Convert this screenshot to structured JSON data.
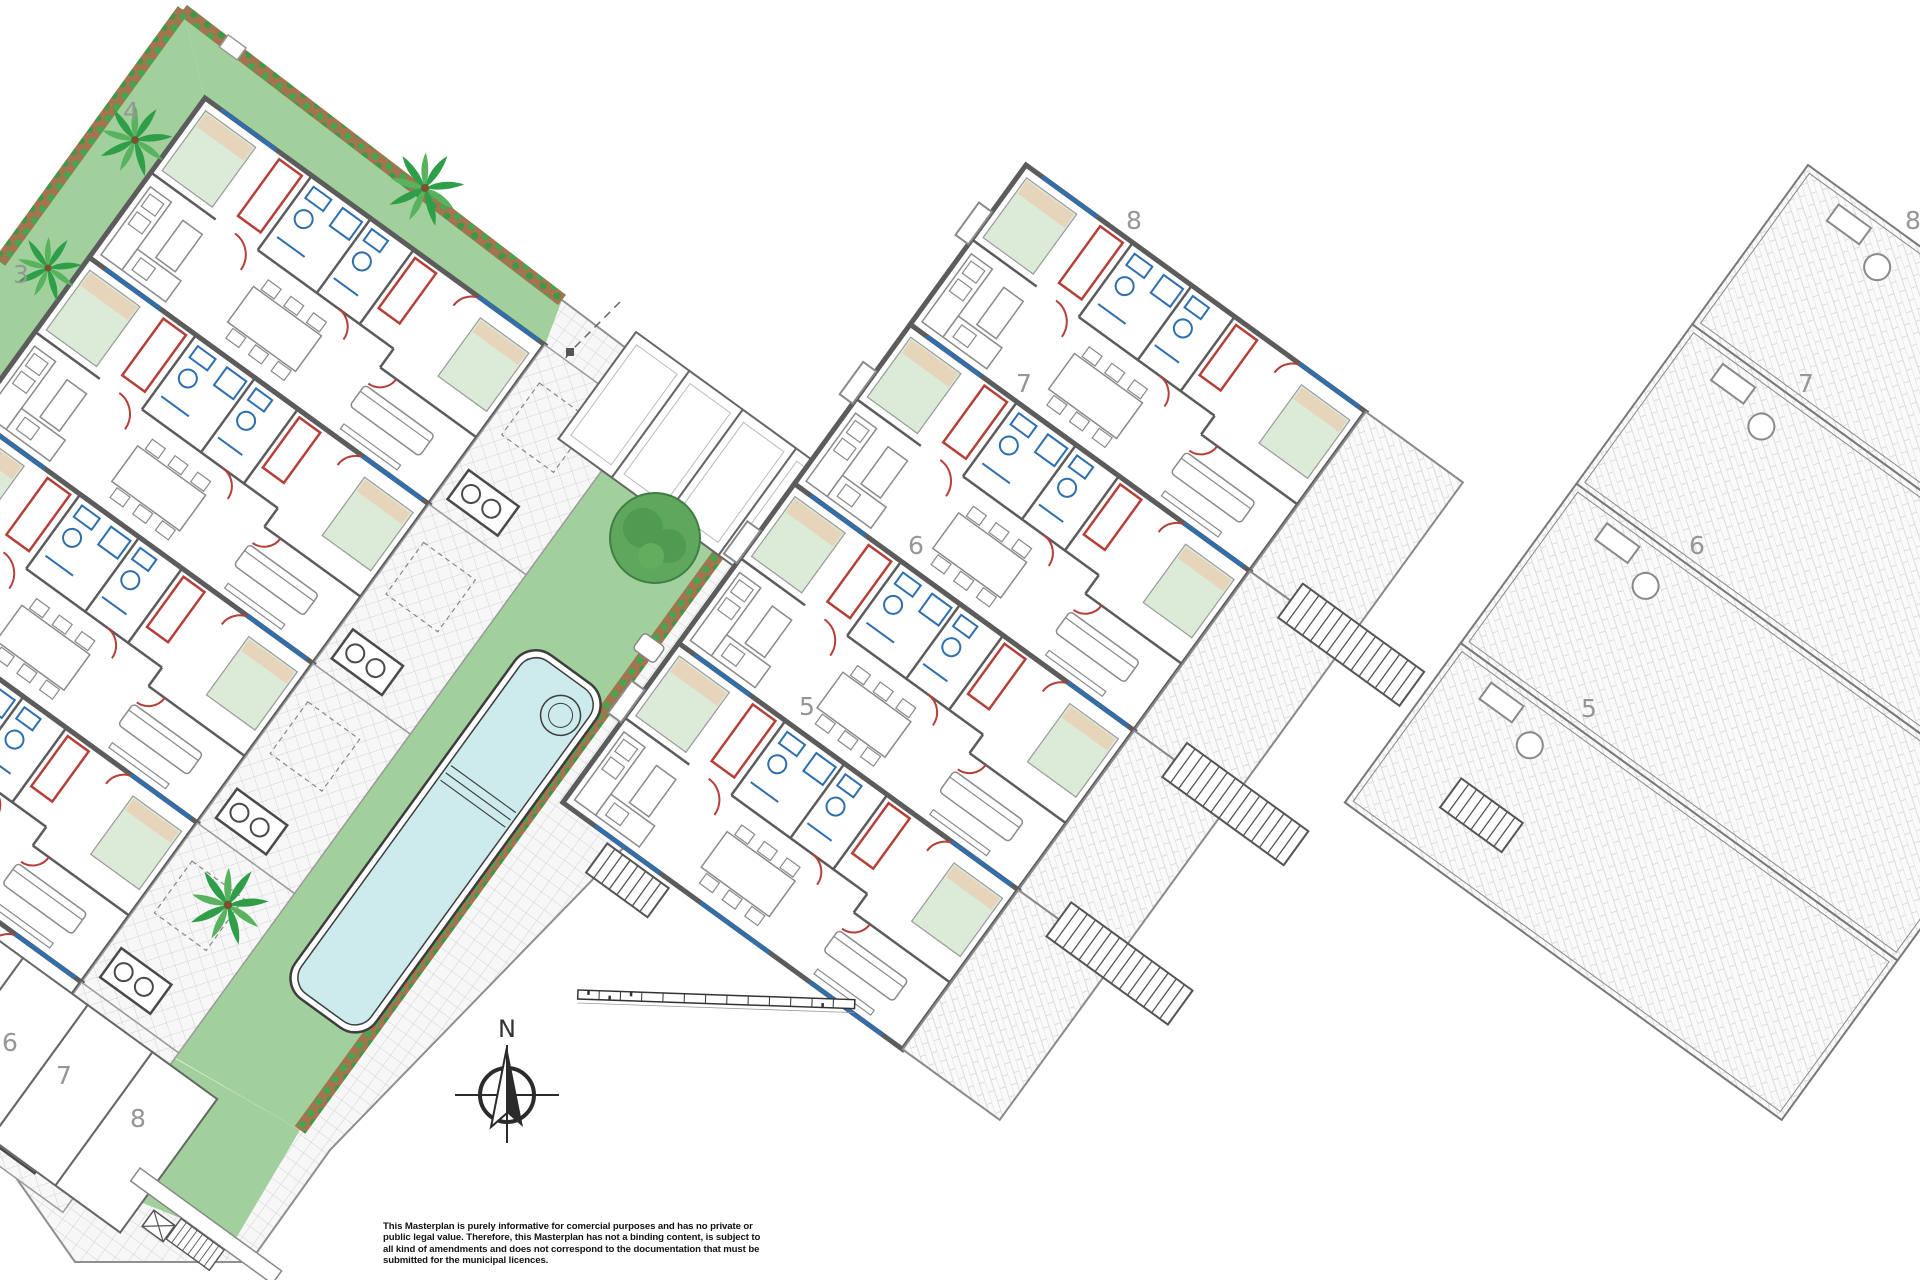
{
  "title": "Residential development masterplan",
  "colors": {
    "background": "#ffffff",
    "garden": "#a2d09c",
    "garden_island": "#a9d4a2",
    "pool_water": "#cdeaed",
    "wall": "#5c5c5c",
    "accent_red": "#b5403a",
    "accent_blue": "#2f6fae",
    "hedge_brown": "#a3744e",
    "hedge_leaf": "#44a64f",
    "bed": "#dcead8",
    "pillow": "#e6d5ba",
    "number_gray": "#969696",
    "paving_line": "#d2d2d2"
  },
  "site": {
    "left_block_units": 5,
    "middle_block_units": 4,
    "right_block_units": 4,
    "carport_stalls": 4,
    "parking_stalls": 4
  },
  "plot_labels": {
    "left": [
      "4",
      "3"
    ],
    "left_parking": [
      "6",
      "7",
      "8"
    ],
    "middle": [
      "8",
      "7",
      "6",
      "5"
    ],
    "right": [
      "8",
      "7",
      "6",
      "5"
    ]
  },
  "compass": {
    "north_label": "N"
  },
  "disclaimer": {
    "lines": [
      "This Masterplan is purely informative for comercial purposes and has no private or",
      "public legal value. Therefore, this Masterplan has not a binding content, is subject to",
      "all kind of amendments and does not correspond to the documentation that must be",
      "submitted for the municipal licences."
    ]
  }
}
